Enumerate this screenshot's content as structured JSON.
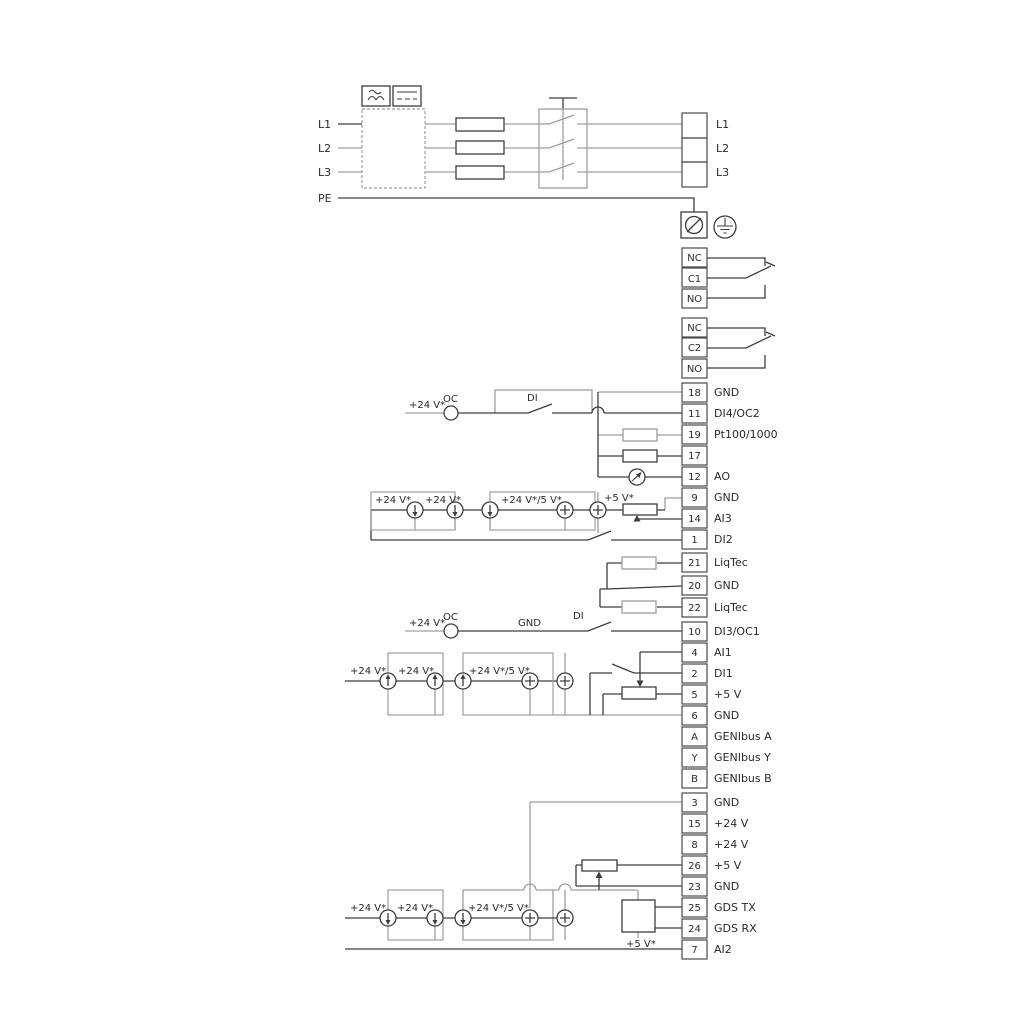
{
  "diagram": {
    "power_inputs": [
      "L1",
      "L2",
      "L3",
      "PE"
    ],
    "power_outputs": [
      "L1",
      "L2",
      "L3"
    ],
    "relay1": [
      "NC",
      "C1",
      "NO"
    ],
    "relay2": [
      "NC",
      "C2",
      "NO"
    ],
    "strip1": [
      {
        "num": "18",
        "label": "GND"
      },
      {
        "num": "11",
        "label": "DI4/OC2"
      },
      {
        "num": "19",
        "label": "Pt100/1000"
      },
      {
        "num": "17",
        "label": "Pt100/1000"
      },
      {
        "num": "12",
        "label": "AO"
      },
      {
        "num": "9",
        "label": "GND"
      },
      {
        "num": "14",
        "label": "AI3"
      },
      {
        "num": "1",
        "label": "DI2"
      }
    ],
    "strip2": [
      {
        "num": "21",
        "label": "LiqTec"
      },
      {
        "num": "20",
        "label": "GND"
      },
      {
        "num": "22",
        "label": "LiqTec"
      }
    ],
    "strip3": [
      {
        "num": "10",
        "label": "DI3/OC1"
      },
      {
        "num": "4",
        "label": "AI1"
      },
      {
        "num": "2",
        "label": "DI1"
      },
      {
        "num": "5",
        "label": "+5 V"
      },
      {
        "num": "6",
        "label": "GND"
      },
      {
        "num": "A",
        "label": "GENIbus A"
      },
      {
        "num": "Y",
        "label": "GENIbus Y"
      },
      {
        "num": "B",
        "label": "GENIbus B"
      }
    ],
    "strip4": [
      {
        "num": "3",
        "label": "GND"
      },
      {
        "num": "15",
        "label": "+24 V"
      },
      {
        "num": "8",
        "label": "+24 V"
      },
      {
        "num": "26",
        "label": "+5 V"
      },
      {
        "num": "23",
        "label": "GND"
      },
      {
        "num": "25",
        "label": "GDS TX"
      },
      {
        "num": "24",
        "label": "GDS RX"
      },
      {
        "num": "7",
        "label": "AI2"
      }
    ],
    "ann": {
      "v24": "+24 V*",
      "v24_5": "+24 V*/5 V*",
      "v5": "+5 V*",
      "oc": "OC",
      "di": "DI",
      "gnd": "GND"
    },
    "colors": {
      "dark": "#3d3d3d",
      "gray": "#9f9f9f",
      "text": "#2a2a2a"
    }
  }
}
